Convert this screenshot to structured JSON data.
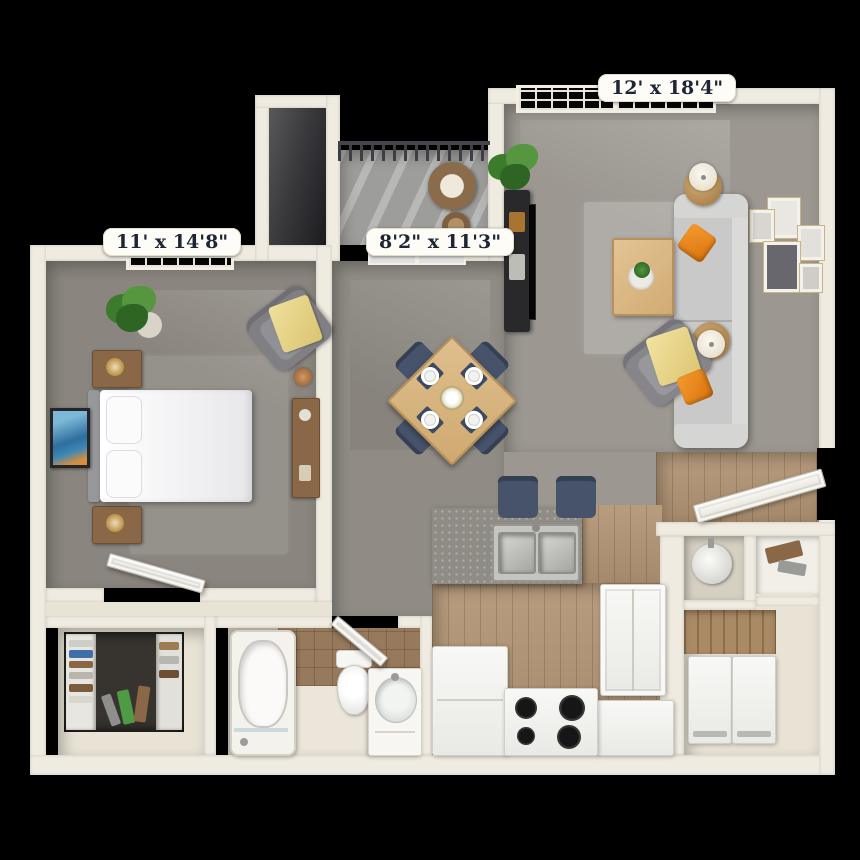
{
  "floor_plan": {
    "labels": {
      "bedroom": "11' x 14'8\"",
      "dining": "8'2\" x 11'3\"",
      "living": "12' x 18'4\""
    },
    "palette": {
      "background": "#000000",
      "wall": "#f0ebe0",
      "carpet_bedroom": "#8a857e",
      "carpet_living": "#9c9891",
      "carpet_dining": "#908c85",
      "wood_floor": "#b29474",
      "bath_floor": "#ece6da",
      "tile_brown": "#97795c",
      "counter_gray": "#8f8c85",
      "dining_table_wood": "#d9b884",
      "chair_navy": "#46536b",
      "sofa_gray": "#c9c9c9",
      "pillow_orange": "#e8871f",
      "plant_green": "#4a8a38",
      "label_text": "#1e2636",
      "label_background": "#fdfcf7"
    }
  }
}
